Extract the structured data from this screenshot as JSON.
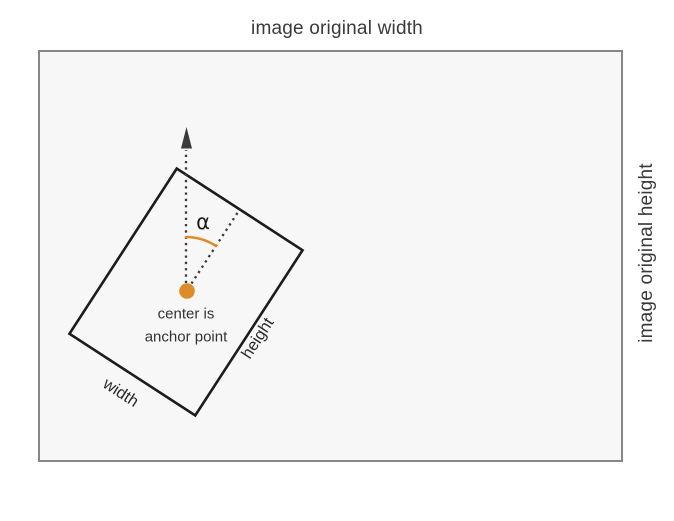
{
  "canvas": {
    "width": 674,
    "height": 521
  },
  "labels": {
    "top": "image original width",
    "right": "image original height",
    "angle": "α",
    "center_caption_line1": "center is",
    "center_caption_line2": "anchor point",
    "rotated_rect_width": "width",
    "rotated_rect_height": "height"
  },
  "colors": {
    "outer_rect_fill": "#f7f7f7",
    "outer_rect_border": "#878787",
    "rotated_rect_stroke": "#1c1c1c",
    "dotted_line": "#3b3b3b",
    "arrow": "#3b3b3b",
    "accent_orange": "#dd8c2a",
    "text": "#3a3a3a"
  },
  "geometry": {
    "rotation_deg": 33,
    "anchor_point": {
      "x": 186,
      "y": 292
    }
  }
}
